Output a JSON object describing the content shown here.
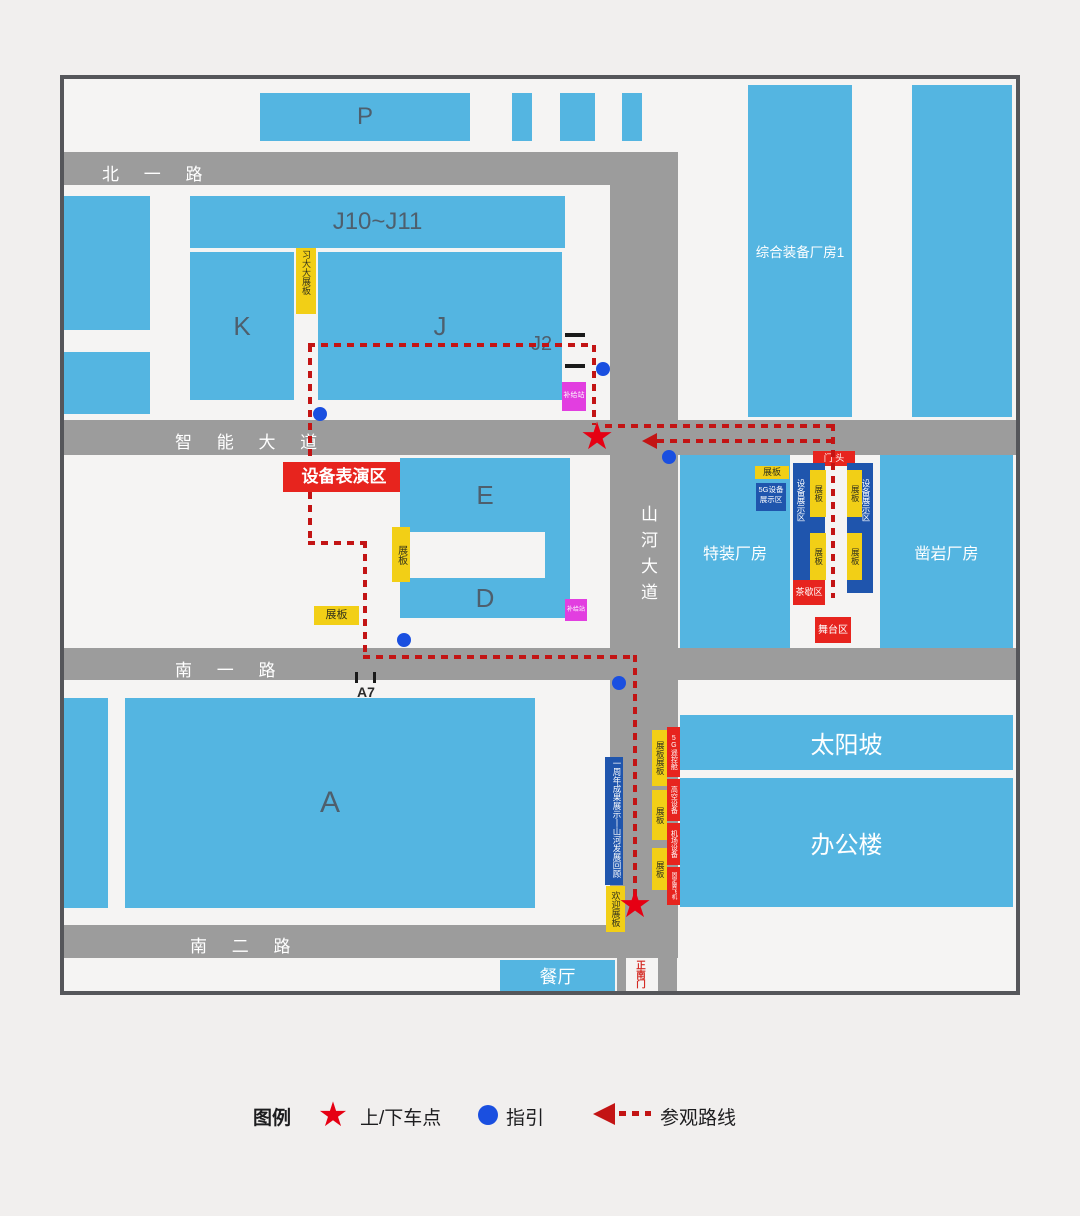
{
  "roads": {
    "north1": "北 一 路",
    "zhineng": "智 能 大 道",
    "nan1": "南 一 路",
    "nan2": "南 二 路",
    "shanhe": "山河大道"
  },
  "buildings": {
    "p": "P",
    "j10": "J10~J11",
    "k": "K",
    "j": "J",
    "j2": "J2",
    "e": "E",
    "d": "D",
    "a": "A",
    "zonghe": "综合装备厂房1",
    "tezhuang": "特装厂房",
    "zaoyan": "凿岩厂房",
    "taiyang": "太阳坡",
    "bangong": "办公楼",
    "canting": "餐厅"
  },
  "labels": {
    "perf": "设备表演区",
    "xiboard": "习大大展板",
    "supply": "补给站",
    "board": "展板",
    "boardDouble": "展板展板",
    "mentou": "门 头",
    "tea": "茶歇区",
    "stage": "舞台区",
    "g5a": "5G设备",
    "g5b": "展示区",
    "devshow": "设备展示区",
    "history": "一周年成果展示丨山河发展回顾",
    "welcome": "欢迎展板",
    "remote": "5G遥控舱",
    "aerial": "高空设备",
    "airport": "机场设备",
    "aircraft": "固定翼飞机",
    "gate": "正南门",
    "a7": "A7"
  },
  "legend": {
    "title": "图例",
    "pickup": "上/下车点",
    "guide": "指引",
    "route": "参观路线"
  },
  "colors": {
    "building_blue": "#54b5e1",
    "road_gray": "#9c9c9c",
    "route_red": "#c31414",
    "star_red": "#e60013",
    "guide_dot_blue": "#1a4fe0",
    "board_yellow": "#f2cf16",
    "exhibit_navy": "#1f55ad",
    "zone_red": "#e7241e",
    "supply_magenta": "#e23ee0"
  }
}
